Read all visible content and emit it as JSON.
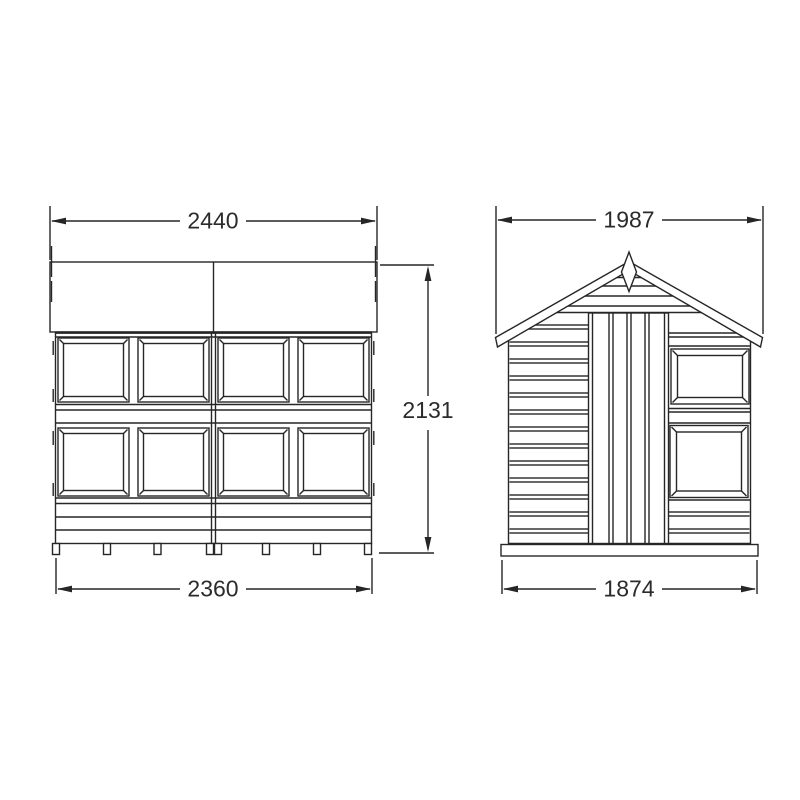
{
  "page": {
    "background": "#ffffff",
    "line_color": "#262626",
    "drawing_type": "shed elevation technical drawing"
  },
  "views": {
    "front": {
      "dim_roof_width": "2440",
      "dim_height": "2131",
      "dim_base_width": "2360"
    },
    "side": {
      "dim_roof_width": "1987",
      "dim_base_width": "1874"
    }
  }
}
